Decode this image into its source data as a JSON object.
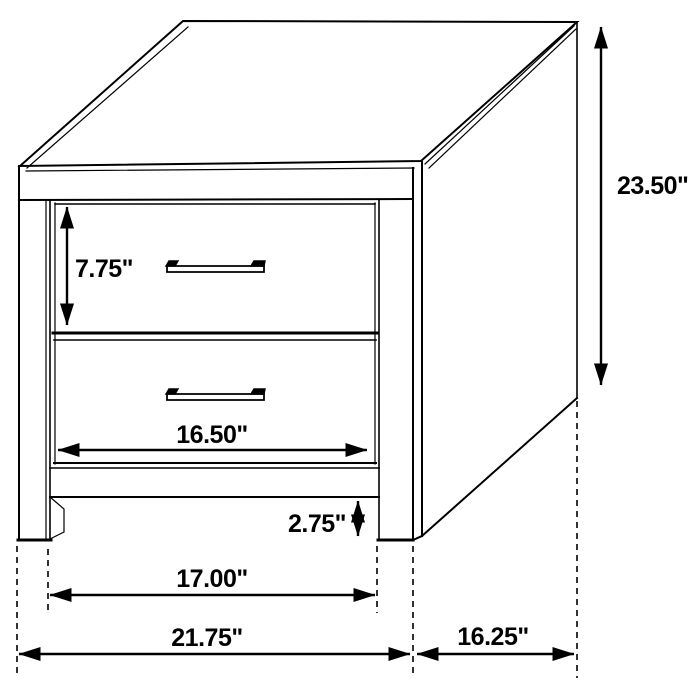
{
  "diagram": {
    "subject": "2-drawer nightstand dimension diagram",
    "background_color": "#ffffff",
    "line_color": "#000000",
    "labels": {
      "overall_height": "23.50\"",
      "drawer_front_height": "7.75\"",
      "drawer_width": "16.50\"",
      "base_clearance": "2.75\"",
      "inner_leg_span": "17.00\"",
      "overall_width": "21.75\"",
      "side_depth": "16.25\""
    }
  }
}
